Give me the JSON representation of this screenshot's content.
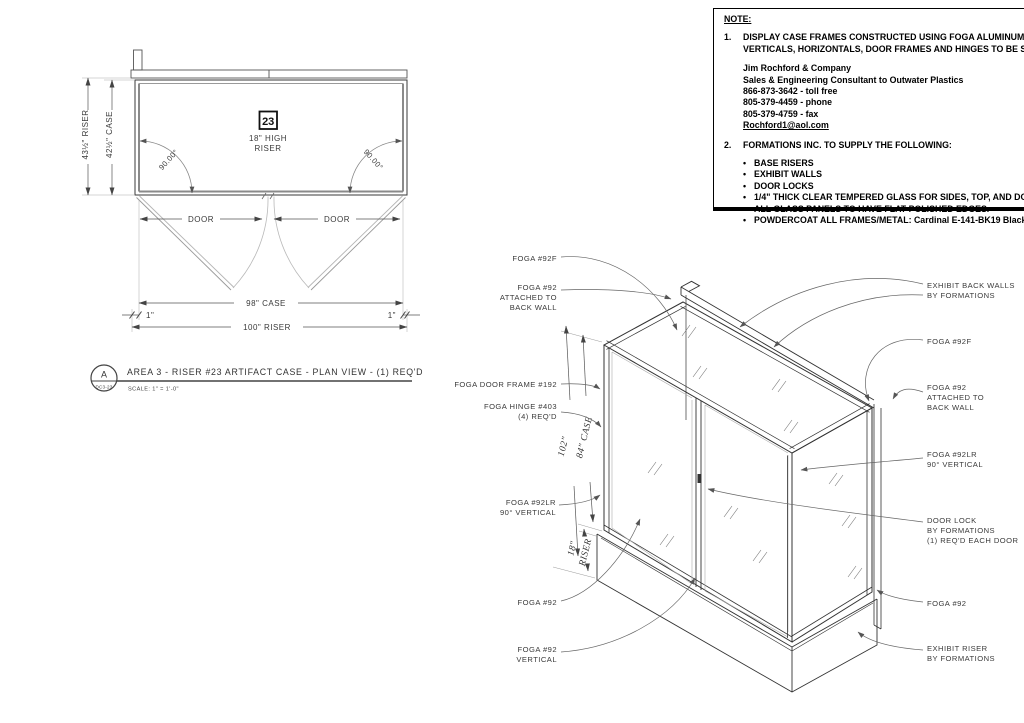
{
  "note": {
    "heading": "NOTE:",
    "bullet": "•",
    "item1_no": "1.",
    "item1_line1": "DISPLAY CASE FRAMES CONSTRUCTED USING FOGA ALUMINUM EXTRUSIONS",
    "item1_line2": "VERTICALS, HORIZONTALS, DOOR FRAMES AND HINGES TO BE SUPPLIED BY:",
    "contact_lines": [
      "Jim Rochford & Company",
      "Sales & Engineering Consultant to Outwater Plastics",
      "866-873-3642 - toll free",
      "805-379-4459 - phone",
      "805-379-4759 - fax"
    ],
    "email": "Rochford1@aol.com",
    "item2_no": "2.",
    "item2_text": "FORMATIONS INC. TO SUPPLY THE FOLLOWING:",
    "supply_items": [
      "BASE RISERS",
      "EXHIBIT WALLS",
      "DOOR LOCKS",
      "1/4\" THICK CLEAR TEMPERED GLASS FOR SIDES, TOP, AND DOORS.",
      "ALL GLASS PANELS TO HAVE FLAT POLISHED EDGES.",
      "POWDERCOAT ALL FRAMES/METAL: Cardinal E-141-BK19 Black Textured"
    ]
  },
  "plan": {
    "tag_number": "23",
    "riser_height_1": "18\" HIGH",
    "riser_height_2": "RISER",
    "angle_left": "90.00°",
    "angle_right": "90.00°",
    "dim_riser_depth": "43½\" RISER",
    "dim_case_depth": "42½\" CASE",
    "door_left": "DOOR",
    "door_right": "DOOR",
    "dim_case_width": "98\" CASE",
    "dim_riser_width": "100\" RISER",
    "dim_offset_left": "1\"",
    "dim_offset_right": "1\""
  },
  "titleblock": {
    "detail_letter": "A",
    "detail_number": "DC3-23",
    "title": "AREA 3 - RISER #23 ARTIFACT CASE - PLAN VIEW - (1) REQ'D",
    "scale": "SCALE: 1\" = 1'-0\""
  },
  "iso": {
    "dim_overall": "102\"",
    "dim_case": "84\" CASE",
    "dim_riser_1": "18\"",
    "dim_riser_2": "RISER",
    "left": {
      "f92f": "FOGA #92F",
      "f92_attached_1": "FOGA #92",
      "f92_attached_2": "ATTACHED TO",
      "f92_attached_3": "BACK WALL",
      "door_frame": "FOGA DOOR FRAME #192",
      "hinge_1": "FOGA HINGE #403",
      "hinge_2": "(4) REQ'D",
      "f92lr_1": "FOGA #92LR",
      "f92lr_2": "90° VERTICAL",
      "f92": "FOGA #92",
      "f92v_1": "FOGA #92",
      "f92v_2": "VERTICAL"
    },
    "right": {
      "back_walls_1": "EXHIBIT BACK WALLS",
      "back_walls_2": "BY FORMATIONS",
      "f92f": "FOGA #92F",
      "f92_attached_1": "FOGA #92",
      "f92_attached_2": "ATTACHED TO",
      "f92_attached_3": "BACK WALL",
      "f92lr_1": "FOGA #92LR",
      "f92lr_2": "90° VERTICAL",
      "door_lock_1": "DOOR LOCK",
      "door_lock_2": "BY FORMATIONS",
      "door_lock_3": "(1) REQ'D EACH DOOR",
      "f92": "FOGA #92",
      "riser_1": "EXHIBIT RISER",
      "riser_2": "BY FORMATIONS"
    }
  }
}
